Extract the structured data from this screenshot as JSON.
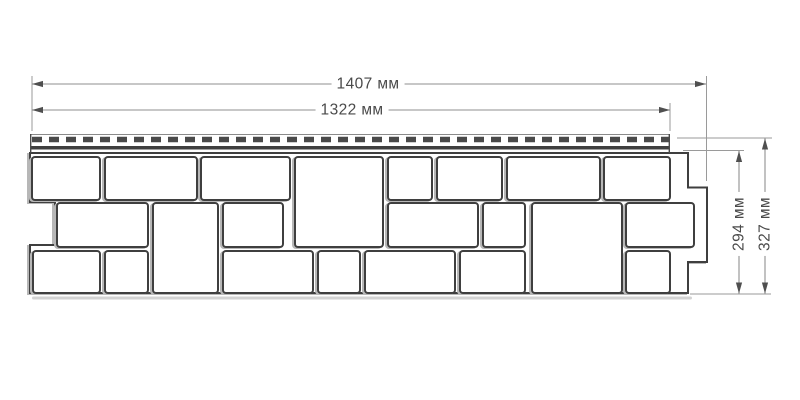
{
  "drawing": {
    "kind": "technical dimension drawing",
    "subject": "facade siding panel with stone-block pattern and perforated nail hem",
    "units": "мм",
    "dimensions": {
      "length_full": "1407 мм",
      "length_working": "1322 мм",
      "height_working": "294 мм",
      "height_full": "327 мм"
    },
    "colors": {
      "background": "#ffffff",
      "outline": "#3f3f3f",
      "hem_slots": "#4a4a4a",
      "dimension_lines": "#8f8f8f",
      "dimension_text": "#4a4a4a",
      "shadow": "#b7b7b7"
    },
    "stones": [
      [
        32,
        157,
        68,
        43
      ],
      [
        105,
        157,
        92,
        43
      ],
      [
        201,
        157,
        89,
        43
      ],
      [
        388,
        157,
        44,
        43
      ],
      [
        437,
        157,
        65,
        43
      ],
      [
        507,
        157,
        93,
        43
      ],
      [
        604,
        157,
        66,
        43
      ],
      [
        295,
        157,
        88,
        90
      ],
      [
        57,
        203,
        91,
        44
      ],
      [
        223,
        203,
        60,
        44
      ],
      [
        388,
        203,
        90,
        44
      ],
      [
        483,
        203,
        42,
        44
      ],
      [
        626,
        203,
        68,
        44
      ],
      [
        153,
        203,
        65,
        90
      ],
      [
        532,
        203,
        90,
        90
      ],
      [
        33,
        251,
        67,
        42
      ],
      [
        105,
        251,
        43,
        42
      ],
      [
        223,
        251,
        90,
        42
      ],
      [
        318,
        251,
        42,
        42
      ],
      [
        365,
        251,
        90,
        42
      ],
      [
        460,
        251,
        65,
        42
      ],
      [
        626,
        251,
        44,
        42
      ]
    ]
  }
}
